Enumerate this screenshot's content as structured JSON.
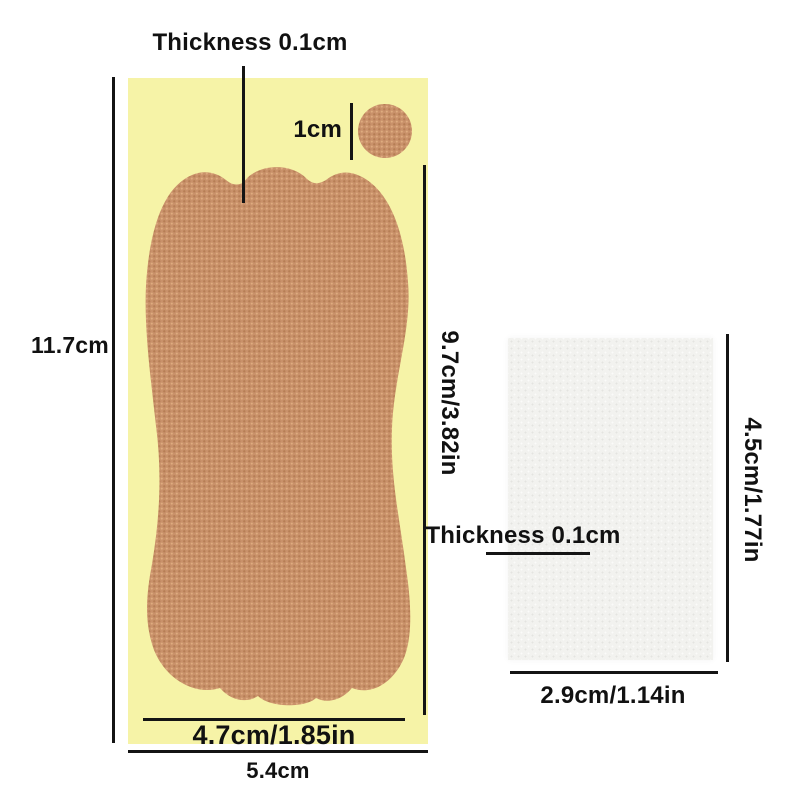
{
  "diagram": {
    "title_context": "adhesive heel patch size diagram",
    "sheet": {
      "height_label": "11.7cm",
      "width_label": "5.4cm",
      "thickness_label": "Thickness 0.1cm"
    },
    "patch": {
      "height_label": "9.7cm/3.82in",
      "width_label": "4.7cm/1.85in",
      "circle_label": "1cm"
    },
    "pad": {
      "thickness_label": "Thickness 0.1cm",
      "height_label": "4.5cm/1.77in",
      "width_label": "2.9cm/1.14in"
    },
    "colors": {
      "sheet_yellow": "#f6f3a7",
      "patch_tan": "#c9916a",
      "patch_weave_dark": "#b1794f",
      "patch_weave_light": "#e2b183",
      "pad_white": "#f2f2ef",
      "dimension_line": "#141414",
      "text": "#111111"
    }
  }
}
